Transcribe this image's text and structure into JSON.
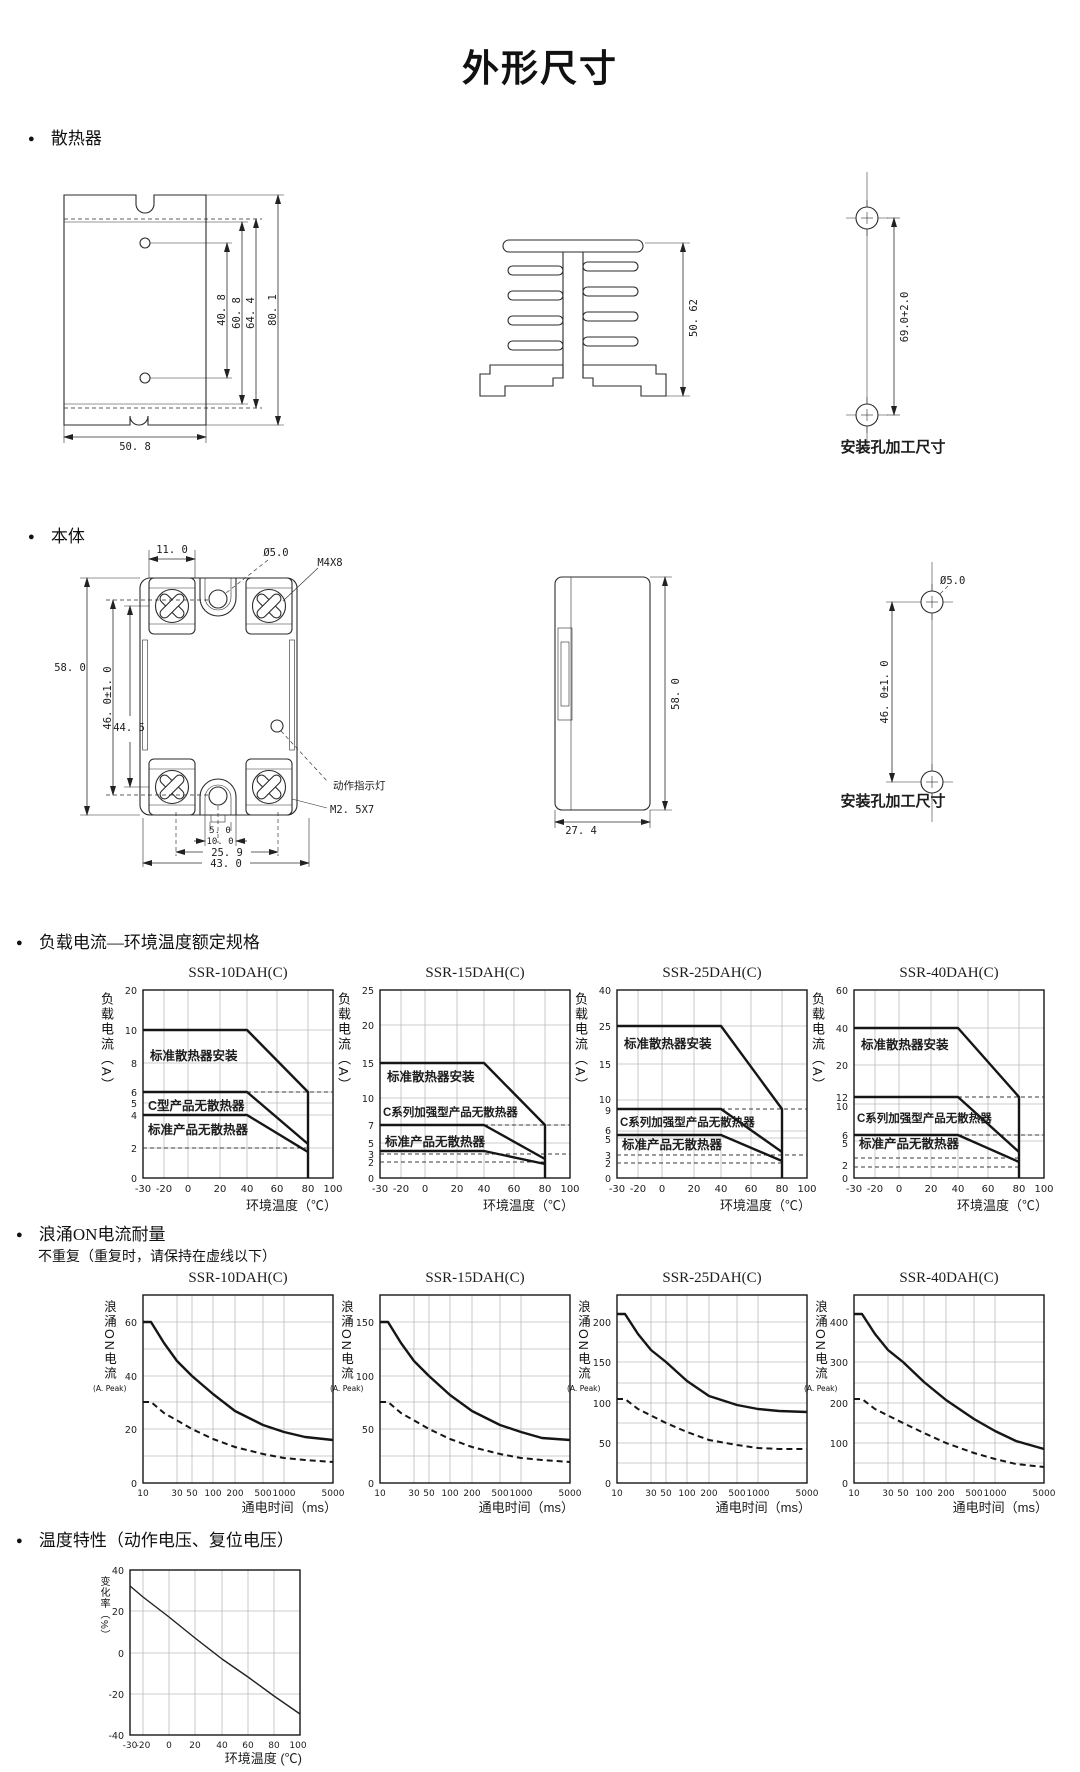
{
  "page_title": "外形尺寸",
  "sections": {
    "heatsink": {
      "heading": "散热器",
      "front": {
        "d1": "40. 8",
        "d2": "60. 8",
        "d3": "64. 4",
        "d4": "80. 1",
        "width": "50. 8"
      },
      "side": {
        "height": "50. 62"
      },
      "holes": {
        "pitch": "69.0+2.0",
        "caption": "安装孔加工尺寸"
      }
    },
    "body": {
      "heading": "本体",
      "front": {
        "w_terminal": "11. 0",
        "hole_dia": "Ø5.0",
        "screw_top": "M4X8",
        "h_total": "58. 0",
        "h_holes": "46. 0±1. 0",
        "h_screws": "44. 5",
        "led": "动作指示灯",
        "screw_bottom": "M2. 5X7",
        "b1": "5. 0",
        "b2": "10. 0",
        "b3": "25. 9",
        "b4": "43. 0"
      },
      "side": {
        "height": "58. 0",
        "depth": "27. 4"
      },
      "holes": {
        "hole_dia": "Ø5.0",
        "pitch": "46. 0±1. 0",
        "caption": "安装孔加工尺寸"
      }
    },
    "load": {
      "heading": "负载电流—环境温度额定规格",
      "ylabel": "负载电流（A）",
      "xlabel": "环境温度（℃）"
    },
    "surge": {
      "heading": "浪涌ON电流耐量",
      "note": "不重复（重复时，请保持在虚线以下）",
      "ylabel": "浪涌ON电流",
      "yunit": "(A. Peak)",
      "xlabel": "通电时间（ms）"
    },
    "temp": {
      "heading": "温度特性（动作电压、复位电压）",
      "ylabel": "变化率（%）",
      "xlabel": "环境温度 (℃)"
    }
  },
  "chart_data": [
    {
      "id": "load-ssr10",
      "type": "line",
      "title": "SSR-10DAH(C)",
      "xlabel": "环境温度（℃）",
      "ylabel": "负载电流（A）",
      "xlim": [
        -30,
        100
      ],
      "x_ticks": [
        "-30",
        "-20",
        "0",
        "20",
        "40",
        "60",
        "80",
        "100"
      ],
      "y_ticks": [
        "20",
        "10",
        "8",
        "6",
        "5",
        "4",
        "2",
        "0"
      ],
      "series": [
        {
          "name": "标准散热器安装",
          "style": "solid",
          "points": [
            [
              -30,
              10
            ],
            [
              40,
              10
            ],
            [
              80,
              6
            ],
            [
              80,
              0
            ]
          ]
        },
        {
          "name": "C型产品无散热器",
          "style": "solid",
          "points": [
            [
              -30,
              6
            ],
            [
              40,
              6
            ],
            [
              80,
              2.3
            ]
          ]
        },
        {
          "name": "标准产品无散热器",
          "style": "solid",
          "points": [
            [
              -30,
              4
            ],
            [
              40,
              4
            ],
            [
              80,
              2
            ]
          ]
        },
        {
          "name": "虚线",
          "style": "dashed",
          "points": [
            [
              40,
              6
            ],
            [
              100,
              6
            ]
          ]
        },
        {
          "name": "虚线",
          "style": "dashed",
          "points": [
            [
              -30,
              2
            ],
            [
              80,
              2
            ]
          ]
        }
      ]
    },
    {
      "id": "load-ssr15",
      "type": "line",
      "title": "SSR-15DAH(C)",
      "xlabel": "环境温度（℃）",
      "ylabel": "负载电流（A）",
      "xlim": [
        -30,
        100
      ],
      "x_ticks": [
        "-30",
        "-20",
        "0",
        "20",
        "40",
        "60",
        "80",
        "100"
      ],
      "y_ticks": [
        "25",
        "20",
        "15",
        "10",
        "7",
        "5",
        "3",
        "2",
        "0"
      ],
      "series": [
        {
          "name": "标准散热器安装",
          "style": "solid",
          "points": [
            [
              -30,
              15
            ],
            [
              40,
              15
            ],
            [
              80,
              7
            ],
            [
              80,
              0
            ]
          ]
        },
        {
          "name": "C系列加强型产品无散热器",
          "style": "solid",
          "points": [
            [
              -30,
              7
            ],
            [
              40,
              7
            ],
            [
              80,
              2.6
            ]
          ]
        },
        {
          "name": "标准产品无散热器",
          "style": "solid",
          "points": [
            [
              -30,
              3.5
            ],
            [
              40,
              3.5
            ],
            [
              80,
              2.2
            ]
          ]
        },
        {
          "name": "虚线",
          "style": "dashed",
          "points": [
            [
              40,
              7
            ],
            [
              100,
              7
            ]
          ]
        },
        {
          "name": "虚线",
          "style": "dashed",
          "points": [
            [
              -30,
              3
            ],
            [
              100,
              3
            ]
          ]
        },
        {
          "name": "虚线",
          "style": "dashed",
          "points": [
            [
              -30,
              2
            ],
            [
              80,
              2
            ]
          ]
        }
      ]
    },
    {
      "id": "load-ssr25",
      "type": "line",
      "title": "SSR-25DAH(C)",
      "xlabel": "环境温度（℃）",
      "ylabel": "负载电流（A）",
      "xlim": [
        -30,
        100
      ],
      "x_ticks": [
        "-30",
        "-20",
        "0",
        "20",
        "40",
        "60",
        "80",
        "100"
      ],
      "y_ticks": [
        "40",
        "25",
        "15",
        "10",
        "9",
        "6",
        "5",
        "3",
        "2",
        "0"
      ],
      "series": [
        {
          "name": "标准散热器安装",
          "style": "solid",
          "points": [
            [
              -30,
              25
            ],
            [
              40,
              25
            ],
            [
              80,
              9
            ],
            [
              80,
              0
            ]
          ]
        },
        {
          "name": "C系列加强型产品无散热器",
          "style": "solid",
          "points": [
            [
              -30,
              9
            ],
            [
              40,
              9
            ],
            [
              80,
              3.2
            ]
          ]
        },
        {
          "name": "标准产品无散热器",
          "style": "solid",
          "points": [
            [
              -30,
              5.5
            ],
            [
              40,
              5.5
            ],
            [
              80,
              2
            ]
          ]
        },
        {
          "name": "虚线",
          "style": "dashed",
          "points": [
            [
              40,
              9
            ],
            [
              100,
              9
            ]
          ]
        },
        {
          "name": "虚线",
          "style": "dashed",
          "points": [
            [
              -30,
              3
            ],
            [
              100,
              3
            ]
          ]
        },
        {
          "name": "虚线",
          "style": "dashed",
          "points": [
            [
              -30,
              2
            ],
            [
              80,
              2
            ]
          ]
        }
      ]
    },
    {
      "id": "load-ssr40",
      "type": "line",
      "title": "SSR-40DAH(C)",
      "xlabel": "环境温度（℃）",
      "ylabel": "负载电流（A）",
      "xlim": [
        -30,
        100
      ],
      "x_ticks": [
        "-30",
        "-20",
        "0",
        "20",
        "40",
        "60",
        "80",
        "100"
      ],
      "y_ticks": [
        "60",
        "40",
        "20",
        "12",
        "10",
        "6",
        "5",
        "2",
        "0"
      ],
      "series": [
        {
          "name": "标准散热器安装",
          "style": "solid",
          "points": [
            [
              -30,
              40
            ],
            [
              40,
              40
            ],
            [
              80,
              12
            ],
            [
              80,
              0
            ]
          ]
        },
        {
          "name": "C系列加强型产品无散热器",
          "style": "solid",
          "points": [
            [
              -30,
              12
            ],
            [
              40,
              12
            ],
            [
              80,
              4
            ]
          ]
        },
        {
          "name": "标准产品无散热器",
          "style": "solid",
          "points": [
            [
              -30,
              6
            ],
            [
              40,
              6
            ],
            [
              80,
              2.2
            ]
          ]
        },
        {
          "name": "虚线",
          "style": "dashed",
          "points": [
            [
              40,
              12
            ],
            [
              100,
              12
            ]
          ]
        },
        {
          "name": "虚线",
          "style": "dashed",
          "points": [
            [
              40,
              6
            ],
            [
              100,
              6
            ]
          ]
        },
        {
          "name": "虚线",
          "style": "dashed",
          "points": [
            [
              -30,
              3
            ],
            [
              80,
              3
            ]
          ]
        },
        {
          "name": "虚线",
          "style": "dashed",
          "points": [
            [
              -30,
              2
            ],
            [
              80,
              2
            ]
          ]
        }
      ]
    },
    {
      "id": "surge-ssr10",
      "type": "line",
      "title": "SSR-10DAH(C)",
      "xlabel": "通电时间（ms）",
      "ylabel": "浪涌ON电流 (A. Peak)",
      "x_scale": "log",
      "xlim": [
        10,
        5000
      ],
      "x_ticks": [
        "10",
        "30",
        "50",
        "100",
        "200",
        "500",
        "1000",
        "5000"
      ],
      "y_ticks": [
        "60",
        "40",
        "20",
        "0"
      ],
      "series": [
        {
          "name": "非重复浪涌电流",
          "style": "solid",
          "points": [
            [
              10,
              60
            ],
            [
              13,
              60
            ],
            [
              20,
              52
            ],
            [
              30,
              45
            ],
            [
              50,
              40
            ],
            [
              100,
              33
            ],
            [
              200,
              27
            ],
            [
              500,
              21
            ],
            [
              1000,
              19
            ],
            [
              2000,
              17
            ],
            [
              5000,
              16
            ]
          ]
        },
        {
          "name": "重复时上限（虚线）",
          "style": "dashed",
          "points": [
            [
              10,
              30
            ],
            [
              13,
              30
            ],
            [
              20,
              26
            ],
            [
              50,
              20
            ],
            [
              100,
              16
            ],
            [
              200,
              13.5
            ],
            [
              500,
              11
            ],
            [
              1000,
              9.5
            ],
            [
              2000,
              8.5
            ],
            [
              5000,
              8
            ]
          ]
        }
      ]
    },
    {
      "id": "surge-ssr15",
      "type": "line",
      "title": "SSR-15DAH(C)",
      "xlabel": "通电时间（ms）",
      "ylabel": "浪涌ON电流 (A. Peak)",
      "x_scale": "log",
      "xlim": [
        10,
        5000
      ],
      "x_ticks": [
        "10",
        "30",
        "50",
        "100",
        "200",
        "500",
        "1000",
        "5000"
      ],
      "y_ticks": [
        "150",
        "100",
        "50",
        "0"
      ],
      "series": [
        {
          "name": "非重复浪涌电流",
          "style": "solid",
          "points": [
            [
              10,
              150
            ],
            [
              13,
              150
            ],
            [
              20,
              130
            ],
            [
              30,
              113
            ],
            [
              50,
              100
            ],
            [
              100,
              82
            ],
            [
              200,
              67
            ],
            [
              500,
              54
            ],
            [
              1000,
              47
            ],
            [
              2000,
              42
            ],
            [
              5000,
              40
            ]
          ]
        },
        {
          "name": "重复时上限（虚线）",
          "style": "dashed",
          "points": [
            [
              10,
              75
            ],
            [
              13,
              75
            ],
            [
              20,
              65
            ],
            [
              50,
              50
            ],
            [
              100,
              41
            ],
            [
              200,
              33
            ],
            [
              500,
              27
            ],
            [
              1000,
              23
            ],
            [
              2000,
              21
            ],
            [
              5000,
              20
            ]
          ]
        }
      ]
    },
    {
      "id": "surge-ssr25",
      "type": "line",
      "title": "SSR-25DAH(C)",
      "xlabel": "通电时间（ms）",
      "ylabel": "浪涌ON电流 (A. Peak)",
      "x_scale": "log",
      "xlim": [
        10,
        5000
      ],
      "x_ticks": [
        "10",
        "30",
        "50",
        "100",
        "200",
        "500",
        "1000",
        "5000"
      ],
      "y_ticks": [
        "200",
        "150",
        "100",
        "50",
        "0"
      ],
      "series": [
        {
          "name": "非重复浪涌电流",
          "style": "solid",
          "points": [
            [
              10,
              210
            ],
            [
              13,
              210
            ],
            [
              20,
              185
            ],
            [
              30,
              165
            ],
            [
              50,
              150
            ],
            [
              100,
              127
            ],
            [
              200,
              108
            ],
            [
              500,
              97
            ],
            [
              1000,
              92
            ],
            [
              2000,
              89
            ],
            [
              5000,
              88
            ]
          ]
        },
        {
          "name": "重复时上限（虚线）",
          "style": "dashed",
          "points": [
            [
              10,
              105
            ],
            [
              13,
              105
            ],
            [
              20,
              92
            ],
            [
              50,
              75
            ],
            [
              100,
              63
            ],
            [
              200,
              54
            ],
            [
              500,
              47
            ],
            [
              1000,
              44
            ],
            [
              2000,
              43
            ],
            [
              5000,
              42
            ]
          ]
        }
      ]
    },
    {
      "id": "surge-ssr40",
      "type": "line",
      "title": "SSR-40DAH(C)",
      "xlabel": "通电时间（ms）",
      "ylabel": "浪涌ON电流 (A. Peak)",
      "x_scale": "log",
      "xlim": [
        10,
        5000
      ],
      "x_ticks": [
        "10",
        "30",
        "50",
        "100",
        "200",
        "500",
        "1000",
        "5000"
      ],
      "y_ticks": [
        "400",
        "300",
        "200",
        "100",
        "0"
      ],
      "series": [
        {
          "name": "非重复浪涌电流",
          "style": "solid",
          "points": [
            [
              10,
              420
            ],
            [
              13,
              420
            ],
            [
              20,
              370
            ],
            [
              30,
              330
            ],
            [
              50,
              300
            ],
            [
              100,
              250
            ],
            [
              200,
              205
            ],
            [
              500,
              160
            ],
            [
              1000,
              130
            ],
            [
              2000,
              105
            ],
            [
              5000,
              85
            ]
          ]
        },
        {
          "name": "重复时上限（虚线）",
          "style": "dashed",
          "points": [
            [
              10,
              210
            ],
            [
              13,
              210
            ],
            [
              20,
              185
            ],
            [
              50,
              150
            ],
            [
              100,
              125
            ],
            [
              200,
              100
            ],
            [
              500,
              75
            ],
            [
              1000,
              60
            ],
            [
              2000,
              48
            ],
            [
              5000,
              40
            ]
          ]
        }
      ]
    },
    {
      "id": "temp-characteristic",
      "type": "line",
      "title": "",
      "xlabel": "环境温度 (℃)",
      "ylabel": "变化率（%）",
      "xlim": [
        -30,
        100
      ],
      "ylim": [
        -40,
        40
      ],
      "x_ticks": [
        "-30",
        "-20",
        "0",
        "20",
        "40",
        "60",
        "80",
        "100"
      ],
      "y_ticks": [
        "40",
        "20",
        "0",
        "-20",
        "-40"
      ],
      "series": [
        {
          "name": "动作电压、复位电压变化率",
          "style": "solid",
          "points": [
            [
              -30,
              32
            ],
            [
              -20,
              27
            ],
            [
              0,
              17
            ],
            [
              20,
              7
            ],
            [
              40,
              -3
            ],
            [
              60,
              -12
            ],
            [
              80,
              -21
            ],
            [
              100,
              -30
            ]
          ]
        }
      ]
    }
  ]
}
